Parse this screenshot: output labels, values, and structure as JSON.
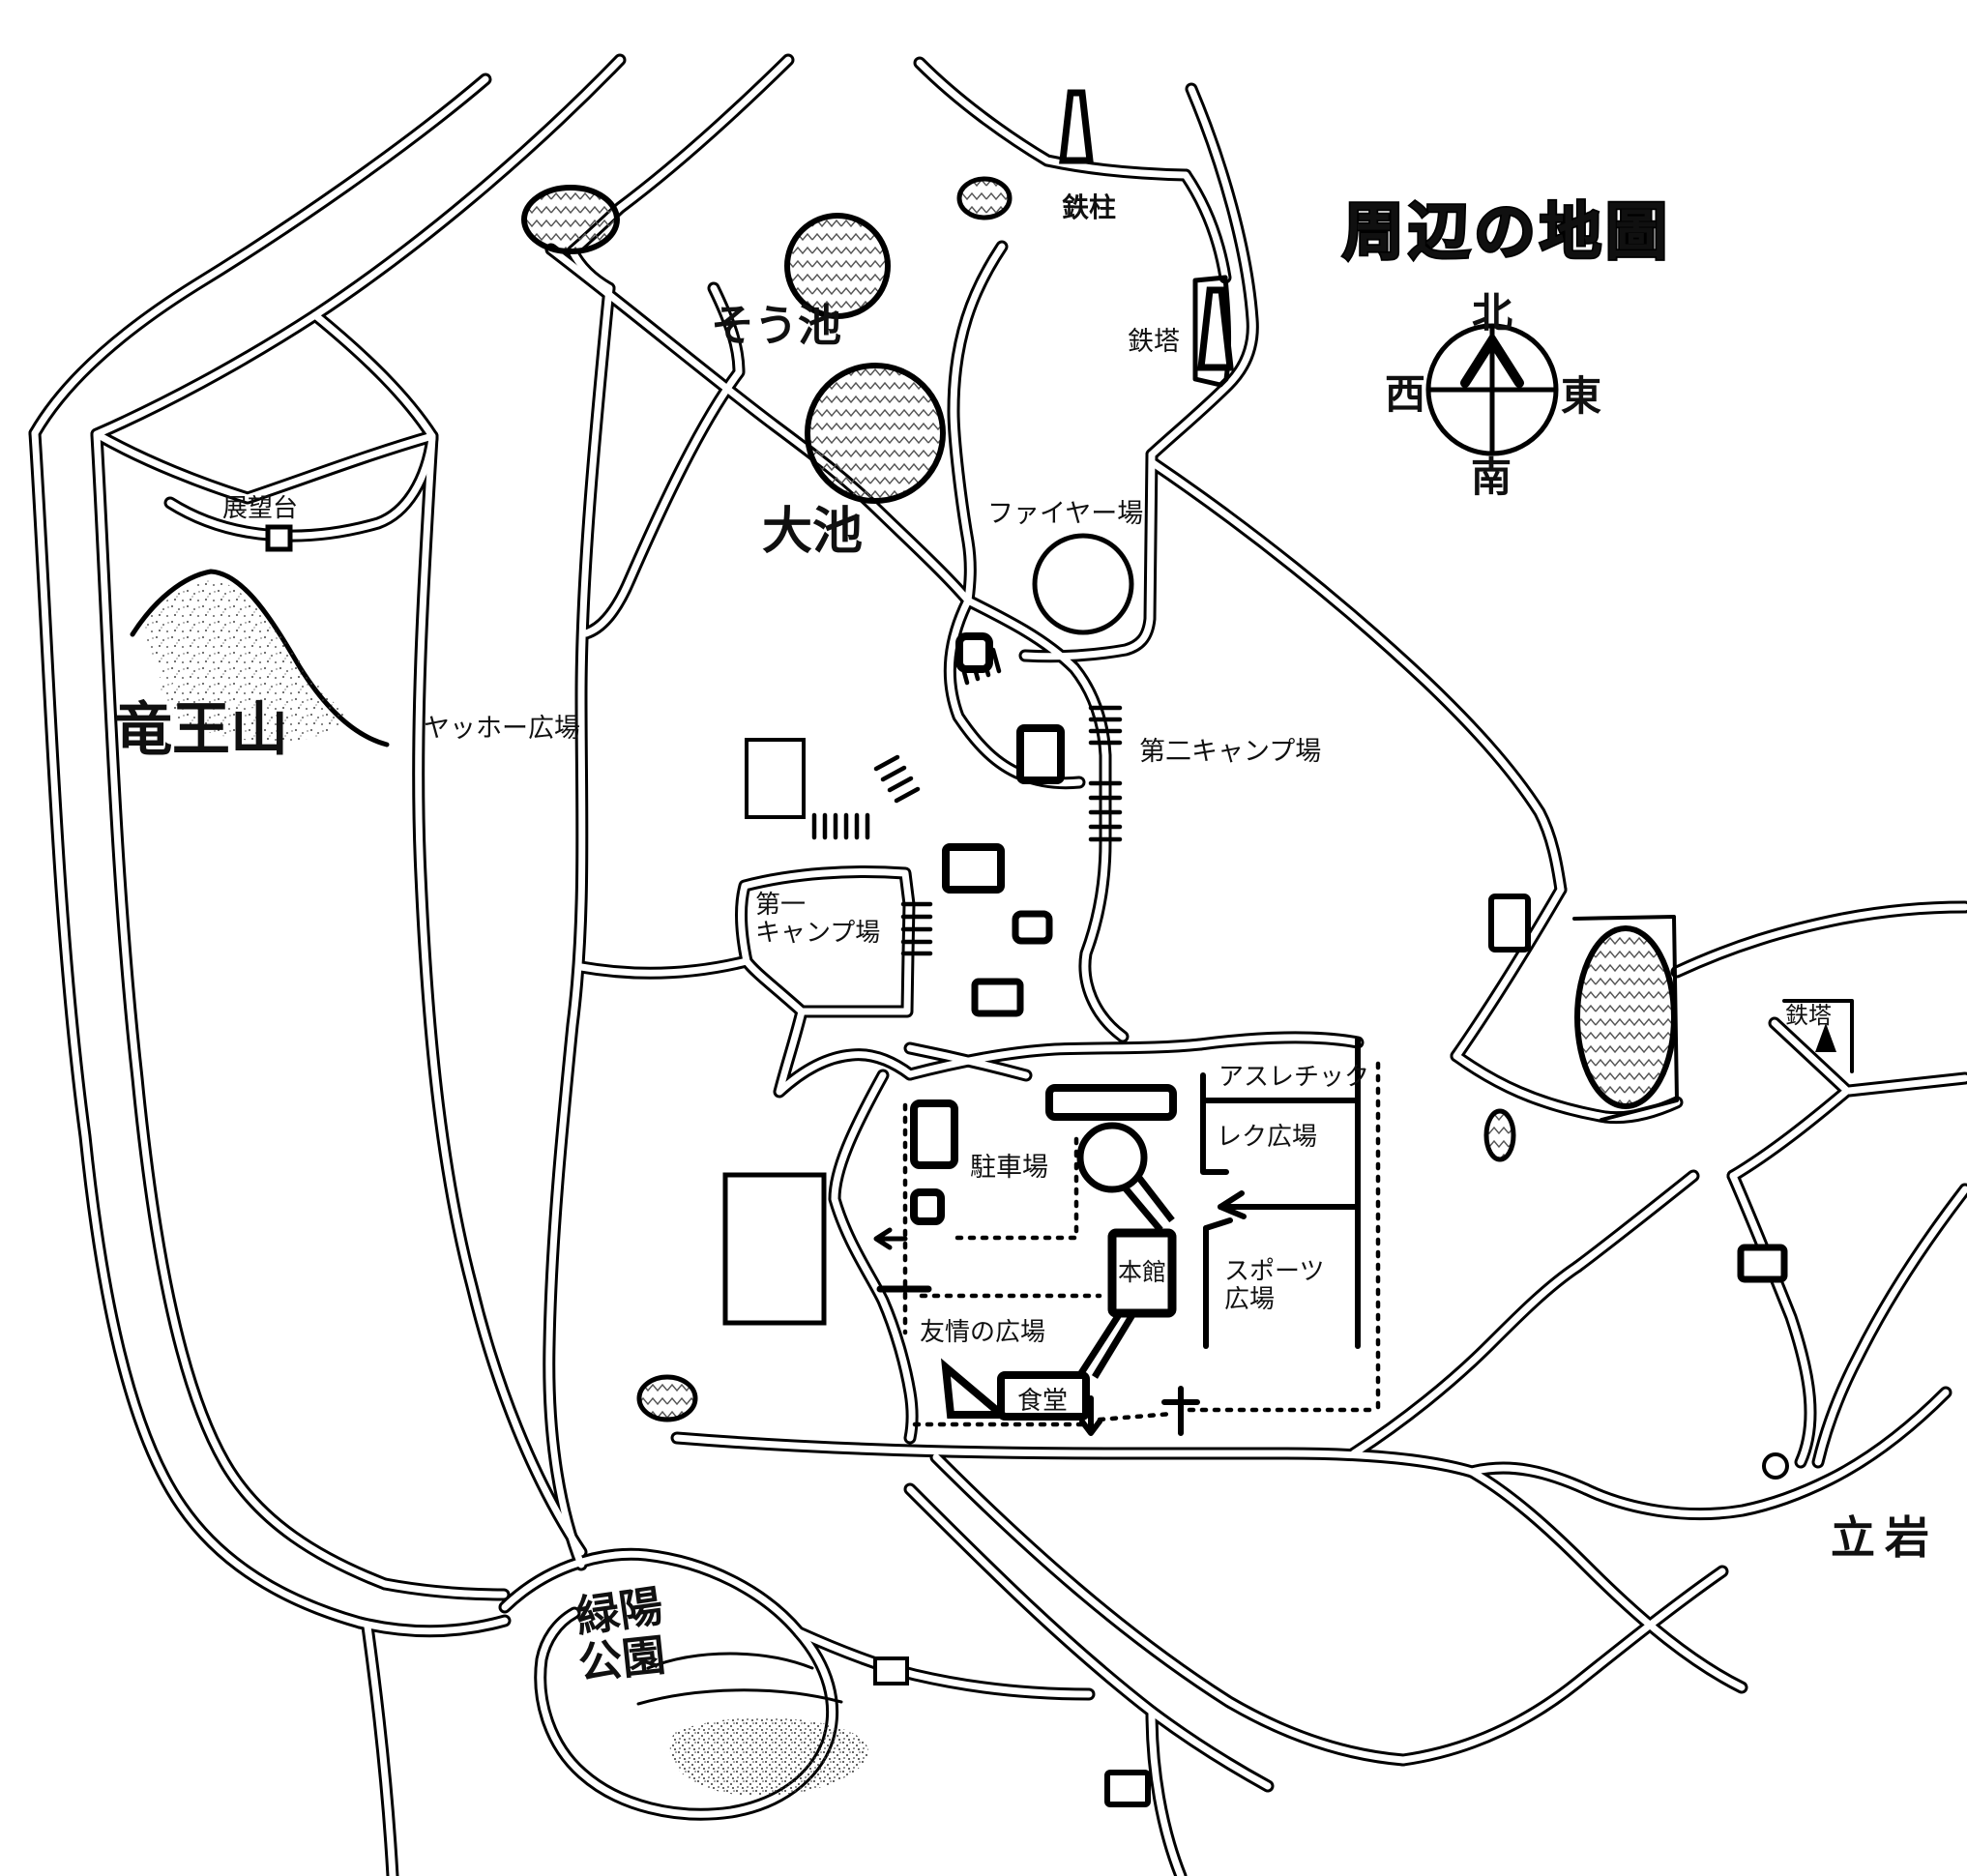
{
  "title": "周辺の地圖",
  "compass": {
    "north": "北",
    "south": "南",
    "east": "東",
    "west": "西"
  },
  "labels": {
    "tetchu": "鉄柱",
    "tetto_top": "鉄塔",
    "so_ike": "そう池",
    "o_ike": "大池",
    "fire_ground": "ファイヤー場",
    "tenbodai": "展望台",
    "ryuo_zan": "竜王山",
    "yahho_hiroba": "ヤッホー広場",
    "daini_camp": "第二キャンプ場",
    "daiichi_camp_line1": "第一",
    "daiichi_camp_line2": "キャンプ場",
    "athletic": "アスレチック",
    "reku_hiroba": "レク広場",
    "chushajo": "駐車場",
    "honkan": "本館",
    "sports_line1": "スポーツ",
    "sports_line2": "広場",
    "yujo_no_hiroba": "友情の広場",
    "shokudo": "食堂",
    "tetto_right": "鉄塔",
    "tateiwa": "立岩",
    "ryokuyo_line1": "緑陽",
    "ryokuyo_line2": "公園"
  },
  "colors": {
    "ink": "#000000",
    "paper": "#ffffff"
  }
}
